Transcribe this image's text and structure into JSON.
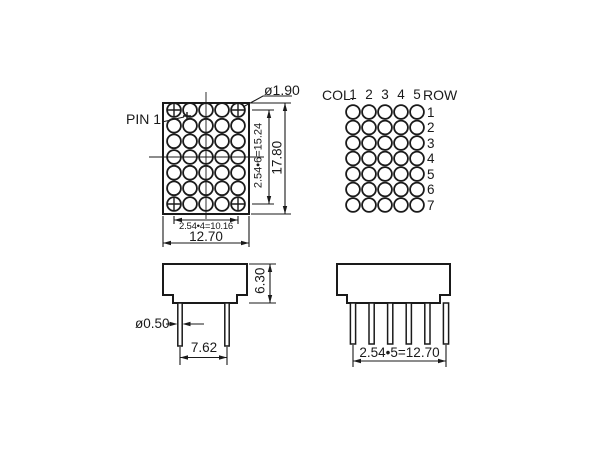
{
  "front_view": {
    "pin1_label": "PIN 1",
    "dot_diameter": "ø1.90",
    "row_pitch": "2.54•6=15.24",
    "overall_height": "17.80",
    "col_pitch": "2.54•4=10.16",
    "overall_width": "12.70"
  },
  "pinout": {
    "col_label": "COL.",
    "row_label": "ROW",
    "col_numbers": [
      "1",
      "2",
      "3",
      "4",
      "5"
    ],
    "row_numbers": [
      "1",
      "2",
      "3",
      "4",
      "5",
      "6",
      "7"
    ],
    "cols": 5,
    "rows": 7
  },
  "side_view": {
    "body_depth": "6.30",
    "pin_diameter": "ø0.50",
    "pin_spacing": "7.62"
  },
  "bottom_view": {
    "pin_pitch": "2.54•5=12.70"
  },
  "colors": {
    "line": "#1a1a1a",
    "background": "#ffffff"
  }
}
